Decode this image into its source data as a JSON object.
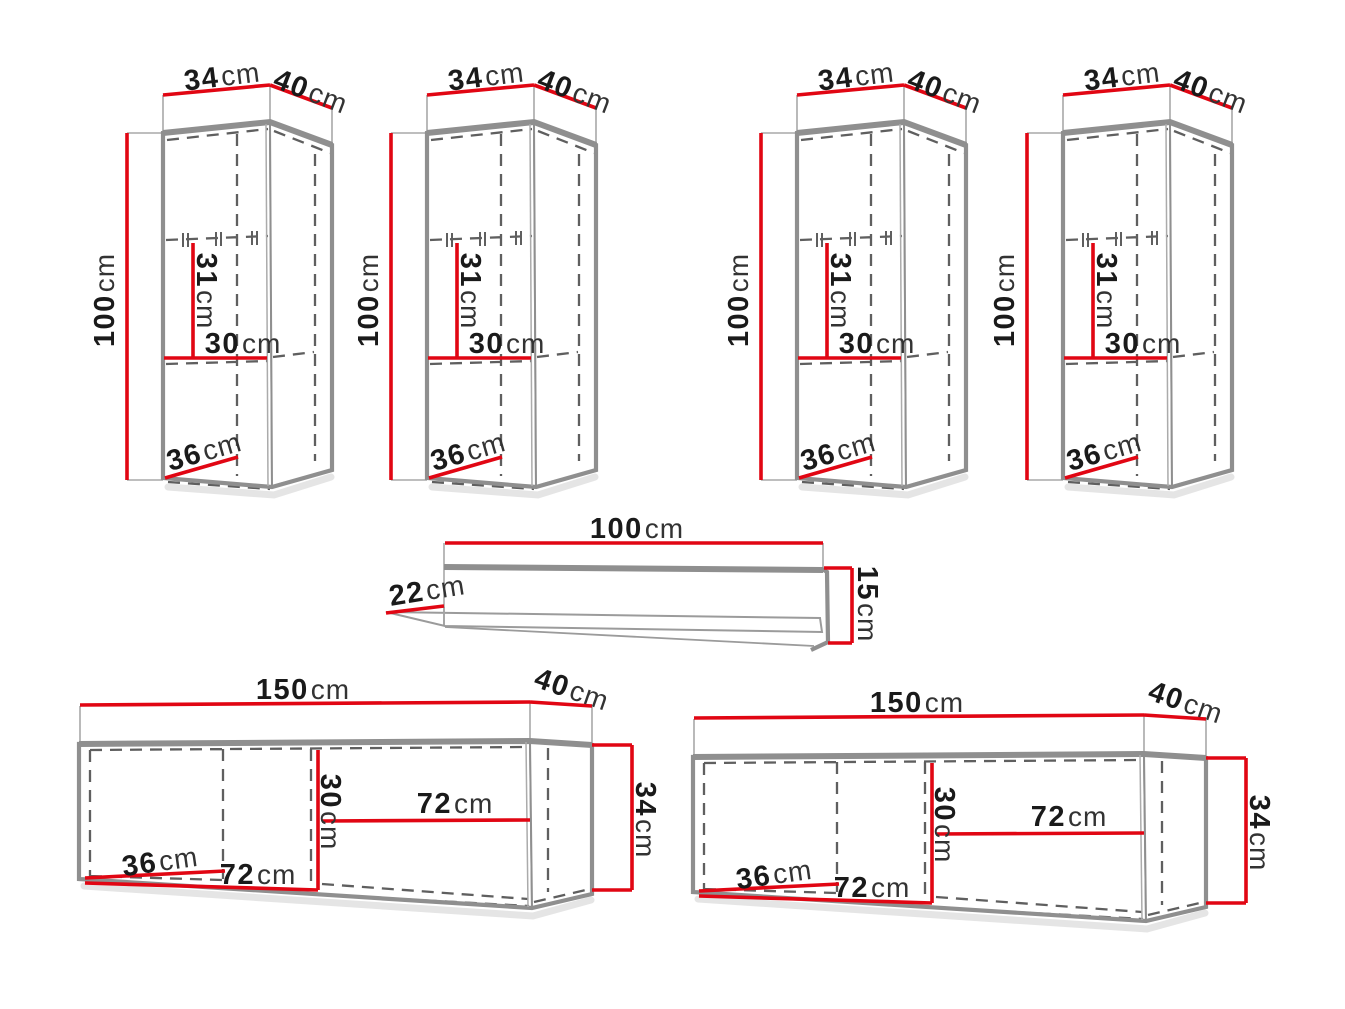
{
  "unit": "cm",
  "colors": {
    "dimension_line": "#e10613",
    "outline_gray": "#8f8f8f",
    "dashed_gray": "#5f5f5f",
    "number_text": "#1a1a1a",
    "unit_text": "#333333",
    "background": "#ffffff"
  },
  "pieces": {
    "tall_cabinet": {
      "width": "34",
      "depth": "40",
      "height": "100",
      "shelf_spacing": "31",
      "inner_width": "30",
      "inner_depth": "36"
    },
    "wall_shelf": {
      "width": "100",
      "depth": "22",
      "height": "15"
    },
    "wide_cabinet": {
      "width": "150",
      "depth": "40",
      "height": "34",
      "inner_height": "30",
      "inner_width_right": "72",
      "inner_depth": "36",
      "inner_width_bottom": "72"
    }
  }
}
